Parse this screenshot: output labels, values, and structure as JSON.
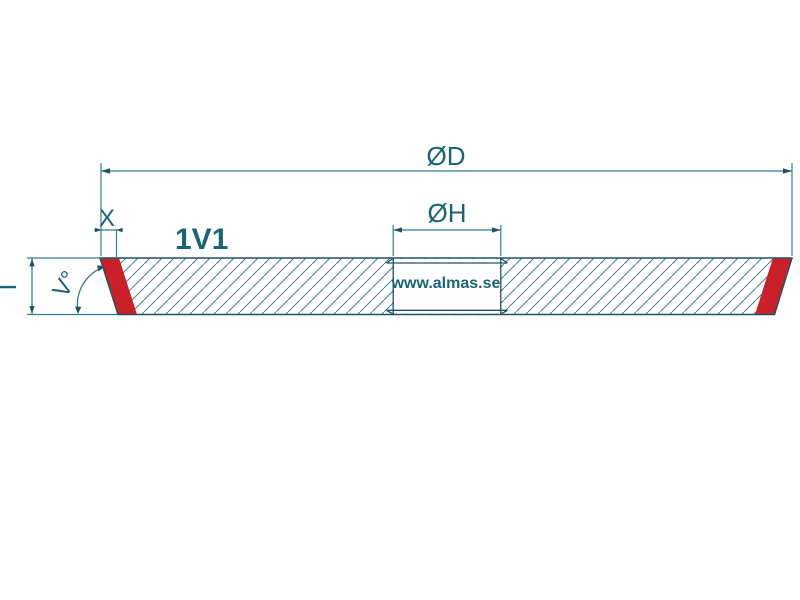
{
  "diagram": {
    "type_label": "1V1",
    "brand": "www.almas.se",
    "dimensions": {
      "outer_diameter": "ØD",
      "bore_diameter": "ØH",
      "rim_width": "X",
      "thickness": "T",
      "face_angle": "V°"
    },
    "colors": {
      "dimension_line": "#2f7f90",
      "outline": "#1f5360",
      "hatch": "#3e8697",
      "label_text": "#1a6478",
      "brand_text": "#16527e",
      "abrasive_red": "#cb2027",
      "background": "#ffffff"
    }
  }
}
